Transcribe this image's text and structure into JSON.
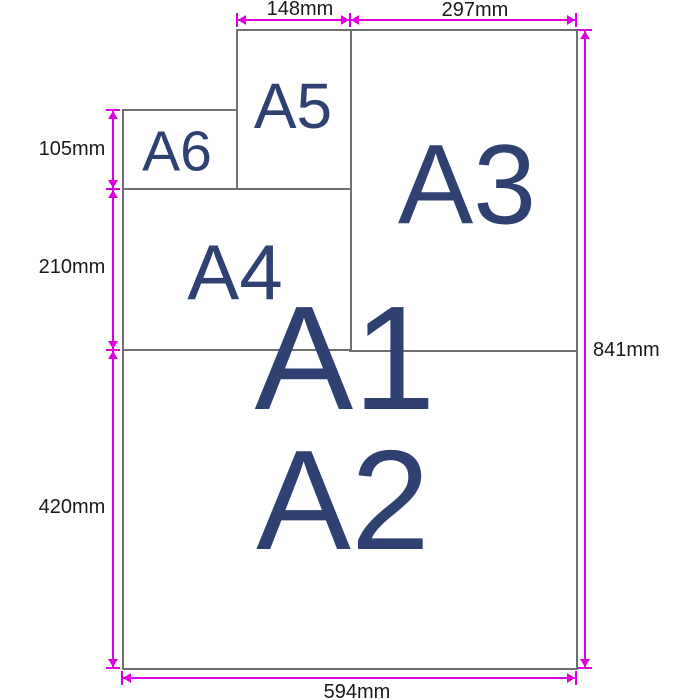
{
  "diagram": {
    "type": "paper-size-diagram",
    "papers": {
      "a1": {
        "label": "A1"
      },
      "a2": {
        "label": "A2"
      },
      "a3": {
        "label": "A3"
      },
      "a4": {
        "label": "A4"
      },
      "a5": {
        "label": "A5"
      },
      "a6": {
        "label": "A6"
      }
    },
    "dims": {
      "d148": {
        "label": "148mm",
        "edge": "top"
      },
      "d297": {
        "label": "297mm",
        "edge": "top"
      },
      "d105": {
        "label": "105mm",
        "edge": "left"
      },
      "d210": {
        "label": "210mm",
        "edge": "left"
      },
      "d420": {
        "label": "420mm",
        "edge": "left"
      },
      "d841": {
        "label": "841mm",
        "edge": "right"
      },
      "d594": {
        "label": "594mm",
        "edge": "bottom"
      }
    },
    "colors": {
      "dimension_line": "#dd00dd",
      "paper_border": "#6f6f6f",
      "paper_label_text": "#2e4170",
      "dimension_text": "#1a1a1a",
      "background": "#ffffff"
    }
  }
}
